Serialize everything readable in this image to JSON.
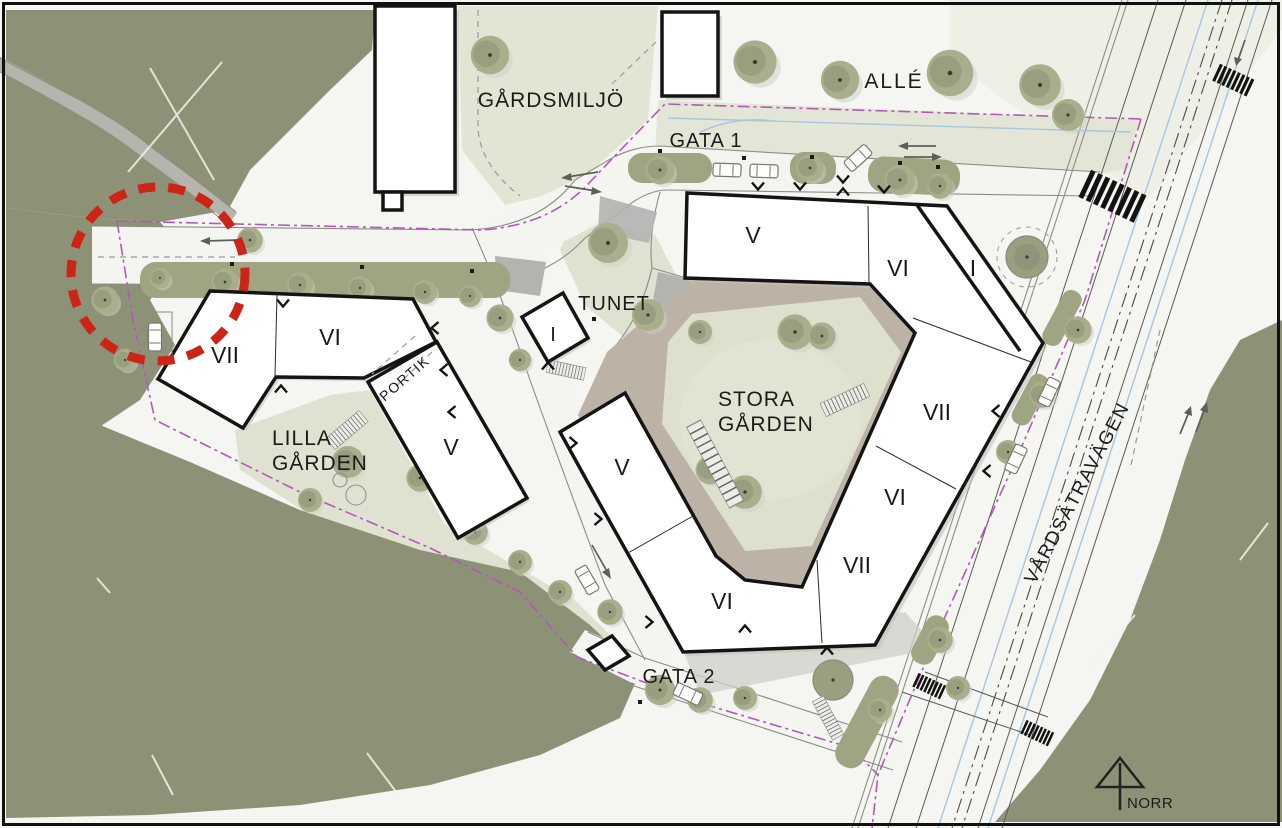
{
  "map": {
    "type": "architectural site plan",
    "streets": {
      "gata1": "GATA 1",
      "gata2": "GATA 2",
      "vardsatravagen": "VÅRDSÄTRAVÄGEN"
    },
    "areas": {
      "gardsmiljo": "GÅRDSMILJÖ",
      "alle": "ALLÉ",
      "tunet": "TUNET",
      "stora_garden": [
        "STORA",
        "GÅRDEN"
      ],
      "lilla_garden": [
        "LILLA",
        "GÅRDEN"
      ],
      "portik": "PORTIK"
    },
    "buildings": {
      "left_vii": "VII",
      "left_vi": "VI",
      "left_v": "V",
      "tunet_i": "I",
      "north_v": "V",
      "north_vi": "VI",
      "northeast_i": "I",
      "east_vii": "VII",
      "east_vi": "VI",
      "south_vii": "VII",
      "south_vi": "VI",
      "west_v": "V"
    },
    "compass": {
      "label": "NORR"
    },
    "annotation": {
      "shape": "dashed-circle",
      "color": "#cc2517"
    },
    "colors": {
      "forest": "#8d9276",
      "lawn": "#dfe2d0",
      "courtyard_walk": "#bdb2a6",
      "road": "#f4f4f1",
      "building_fill": "#ffffff",
      "outline": "#141414",
      "boundary_line": "#b05ab5",
      "bike_lane": "#a8c5e2",
      "tree": "#9aa07e",
      "annotation_red": "#cc2517"
    }
  }
}
